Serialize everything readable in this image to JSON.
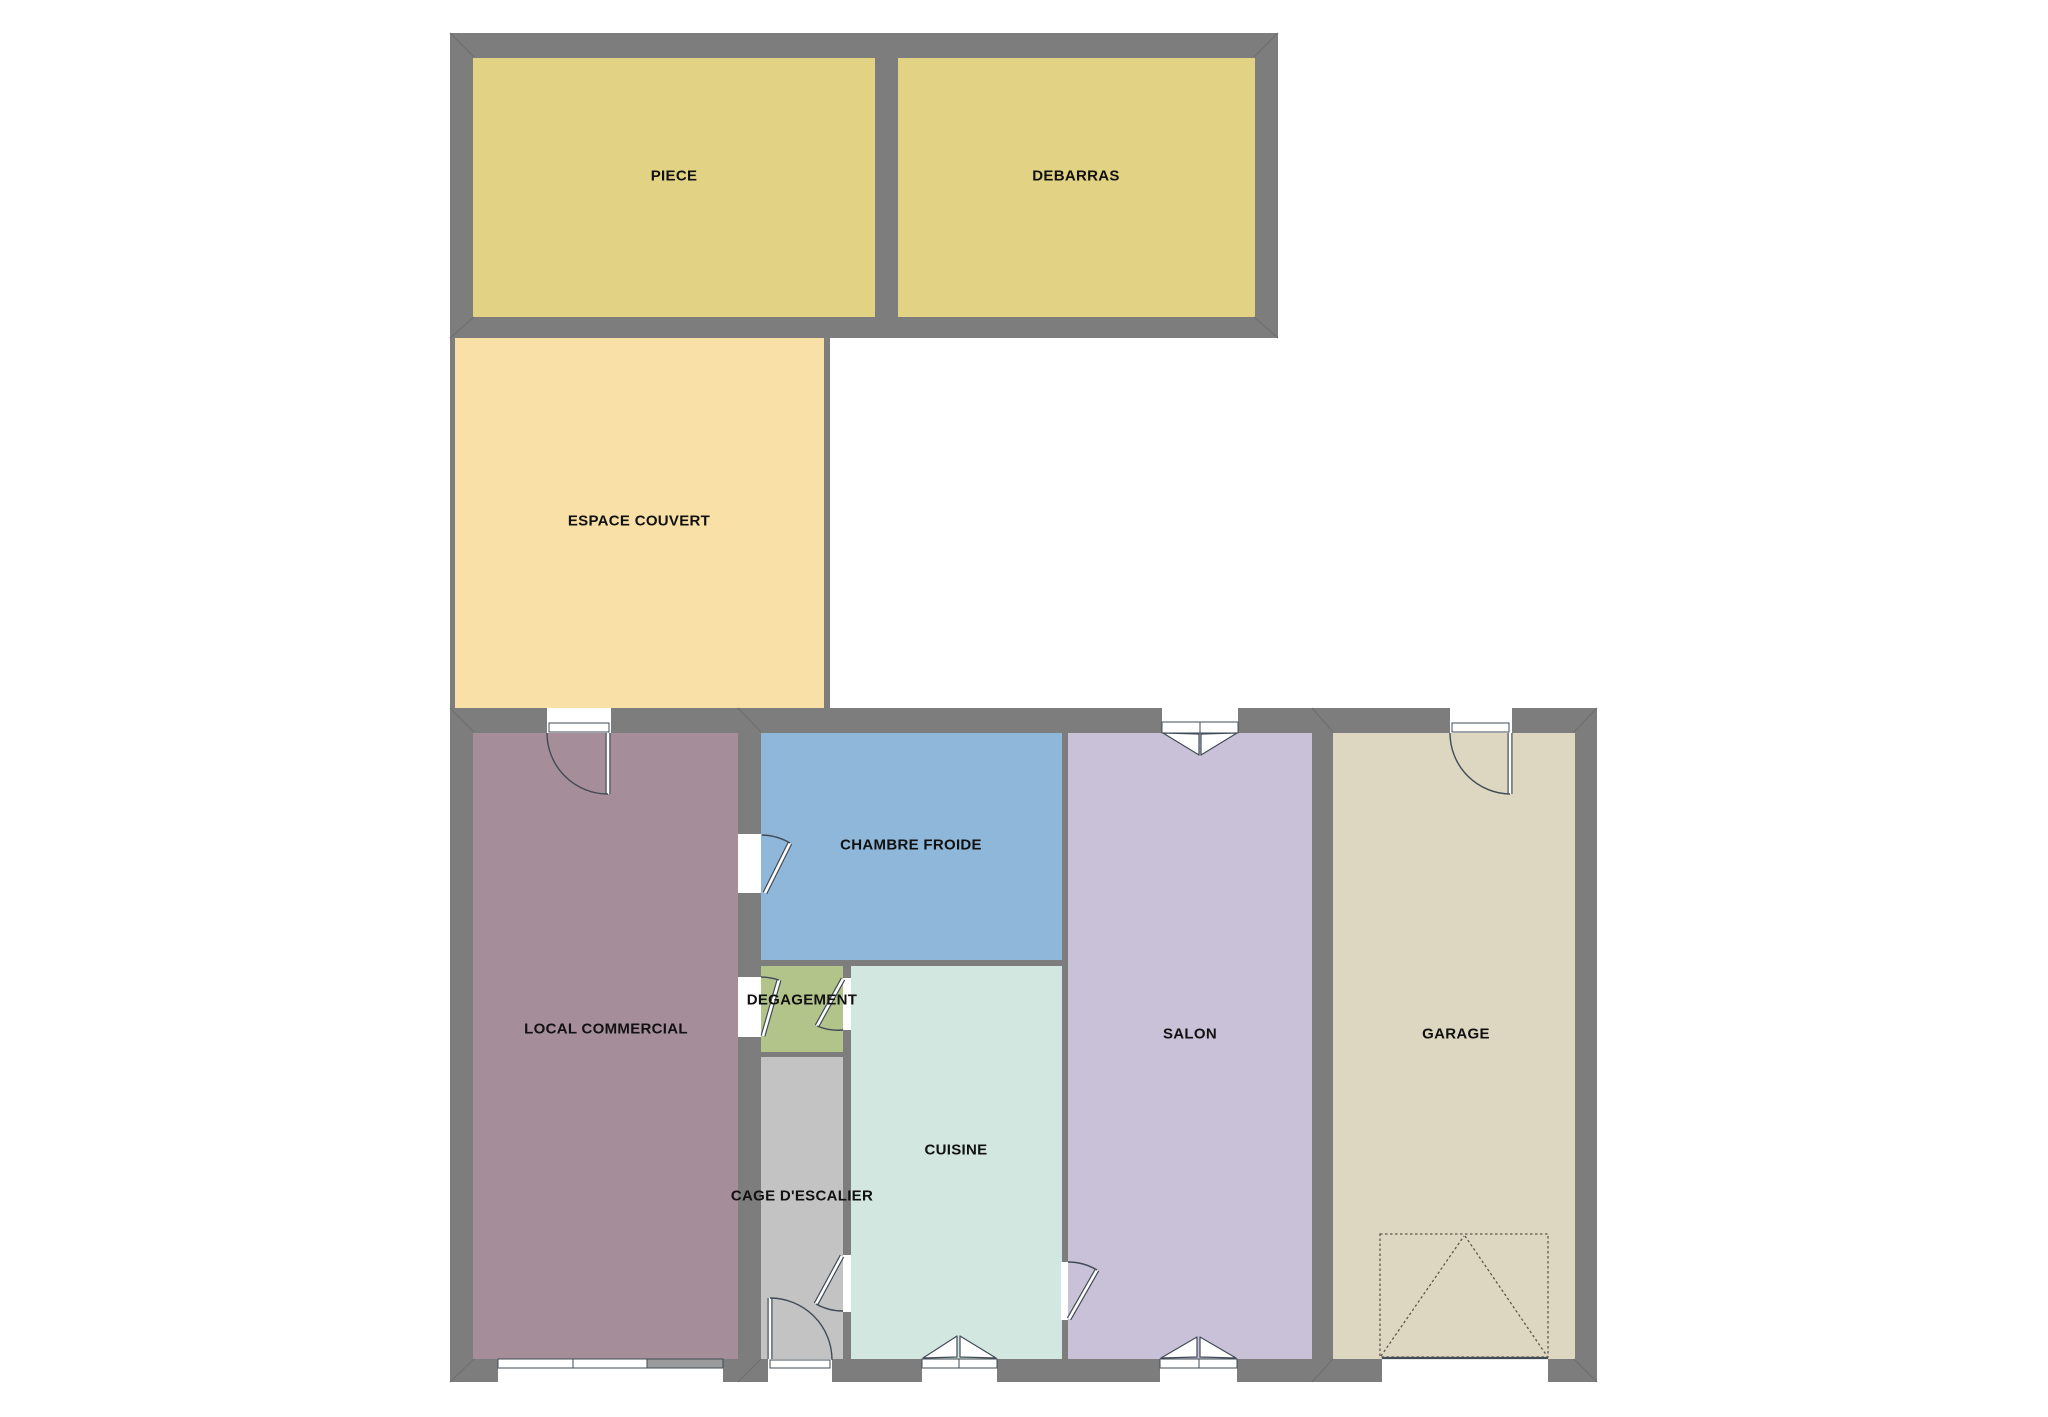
{
  "plan_title": "Floor plan",
  "colors": {
    "background": "#ffffff",
    "wall": "#7d7d7d",
    "wall_miter": "#6f6f6f",
    "line": "#414b56",
    "frame_fill": "#ffffff",
    "storefront_panel": "#9b9b9b",
    "garage_dash": "#5c584a",
    "label_text": "#111111"
  },
  "sections": [
    {
      "name": "upper-building",
      "x": 450,
      "y": 33,
      "w": 828,
      "h": 305
    },
    {
      "name": "espace-couvert-border",
      "x": 450,
      "y": 338,
      "w": 380,
      "h": 370
    },
    {
      "name": "lower-building",
      "x": 450,
      "y": 708,
      "w": 1147,
      "h": 674
    }
  ],
  "rooms": [
    {
      "id": "piece",
      "label": "PIECE",
      "color": "#e2d283",
      "x": 473,
      "y": 58,
      "w": 402,
      "h": 259,
      "label_cx": 674,
      "label_cy": 176
    },
    {
      "id": "debarras",
      "label": "DEBARRAS",
      "color": "#e2d283",
      "x": 898,
      "y": 58,
      "w": 357,
      "h": 259,
      "label_cx": 1076,
      "label_cy": 176
    },
    {
      "id": "espace-couvert",
      "label": "ESPACE COUVERT",
      "color": "#f8e0a6",
      "x": 455,
      "y": 338,
      "w": 369,
      "h": 370,
      "label_cx": 639,
      "label_cy": 521
    },
    {
      "id": "local-commercial",
      "label": "LOCAL COMMERCIAL",
      "color": "#a68d9a",
      "x": 473,
      "y": 733,
      "w": 265,
      "h": 626,
      "label_cx": 606,
      "label_cy": 1029
    },
    {
      "id": "chambre-froide",
      "label": "CHAMBRE FROIDE",
      "color": "#8fb7d9",
      "x": 761,
      "y": 733,
      "w": 301,
      "h": 227,
      "label_cx": 911,
      "label_cy": 845
    },
    {
      "id": "degagement",
      "label": "DEGAGEMENT",
      "color": "#b2c489",
      "x": 761,
      "y": 966,
      "w": 82,
      "h": 86,
      "label_cx": 802,
      "label_cy": 1000
    },
    {
      "id": "cuisine",
      "label": "CUISINE",
      "color": "#d2e7df",
      "x": 851,
      "y": 966,
      "w": 211,
      "h": 393,
      "label_cx": 956,
      "label_cy": 1150
    },
    {
      "id": "cage-escalier",
      "label": "CAGE D'ESCALIER",
      "color": "#c3c3c3",
      "x": 761,
      "y": 1057,
      "w": 82,
      "h": 302,
      "label_cx": 802,
      "label_cy": 1196
    },
    {
      "id": "salon",
      "label": "SALON",
      "color": "#c9c1d8",
      "x": 1068,
      "y": 733,
      "w": 244,
      "h": 626,
      "label_cx": 1190,
      "label_cy": 1034
    },
    {
      "id": "garage",
      "label": "GARAGE",
      "color": "#ddd7c1",
      "x": 1333,
      "y": 733,
      "w": 242,
      "h": 626,
      "label_cx": 1456,
      "label_cy": 1034
    }
  ],
  "openings": [
    {
      "name": "local-commercial-entry",
      "x": 547,
      "y": 708,
      "w": 64,
      "h": 25
    },
    {
      "name": "storefront-window",
      "x": 498,
      "y": 1359,
      "w": 225,
      "h": 23
    },
    {
      "name": "chambre-froide-door",
      "x": 738,
      "y": 834,
      "w": 23,
      "h": 59
    },
    {
      "name": "degagement-left-door",
      "x": 738,
      "y": 977,
      "w": 23,
      "h": 60
    },
    {
      "name": "degagement-right-door",
      "x": 843,
      "y": 978,
      "w": 8,
      "h": 52
    },
    {
      "name": "cage-interior-door",
      "x": 843,
      "y": 1255,
      "w": 8,
      "h": 57
    },
    {
      "name": "cage-exit-door",
      "x": 768,
      "y": 1359,
      "w": 64,
      "h": 23
    },
    {
      "name": "cuisine-exit-door",
      "x": 922,
      "y": 1359,
      "w": 75,
      "h": 23
    },
    {
      "name": "salon-window-top",
      "x": 1162,
      "y": 708,
      "w": 76,
      "h": 25
    },
    {
      "name": "salon-window-bottom",
      "x": 1160,
      "y": 1359,
      "w": 77,
      "h": 23
    },
    {
      "name": "cuisine-salon-door",
      "x": 1061,
      "y": 1262,
      "w": 7,
      "h": 58
    },
    {
      "name": "garage-entry-door",
      "x": 1450,
      "y": 708,
      "w": 62,
      "h": 25
    },
    {
      "name": "garage-door-opening",
      "x": 1382,
      "y": 1359,
      "w": 166,
      "h": 23
    }
  ],
  "frames": [
    {
      "name": "local-commercial-entry-frame",
      "x": 549,
      "y": 723,
      "w": 60,
      "h": 9,
      "dividers": []
    },
    {
      "name": "garage-entry-frame",
      "x": 1452,
      "y": 723,
      "w": 57,
      "h": 9,
      "dividers": []
    },
    {
      "name": "salon-window-top-frame",
      "x": 1162,
      "y": 722,
      "w": 76,
      "h": 11,
      "dividers": [
        1200
      ]
    },
    {
      "name": "storefront-frame",
      "x": 498,
      "y": 1359,
      "w": 225,
      "h": 9,
      "dividers": [
        573,
        647
      ],
      "panel": {
        "x": 647,
        "w": 76
      }
    },
    {
      "name": "cage-exit-frame",
      "x": 770,
      "y": 1360,
      "w": 60,
      "h": 8,
      "dividers": []
    },
    {
      "name": "cuisine-exit-frame",
      "x": 922,
      "y": 1359,
      "w": 75,
      "h": 9,
      "dividers": [
        959
      ]
    },
    {
      "name": "salon-window-bottom-frame",
      "x": 1160,
      "y": 1359,
      "w": 77,
      "h": 9,
      "dividers": [
        1199
      ]
    }
  ],
  "door_leaves": [
    {
      "name": "local-commercial-entry-leaf",
      "x1": 608,
      "y1": 733,
      "x2": 608,
      "y2": 794
    },
    {
      "name": "chambre-froide-leaf",
      "x1": 765,
      "y1": 893,
      "x2": 790,
      "y2": 843
    },
    {
      "name": "degagement-left-leaf",
      "x1": 763,
      "y1": 1036,
      "x2": 779,
      "y2": 980
    },
    {
      "name": "degagement-right-leaf",
      "x1": 843,
      "y1": 979,
      "x2": 817,
      "y2": 1026
    },
    {
      "name": "cage-interior-leaf",
      "x1": 842,
      "y1": 1256,
      "x2": 816,
      "y2": 1304
    },
    {
      "name": "cage-exit-leaf",
      "x1": 770,
      "y1": 1298,
      "x2": 770,
      "y2": 1359
    },
    {
      "name": "cuisine-salon-leaf",
      "x1": 1069,
      "y1": 1319,
      "x2": 1097,
      "y2": 1270
    },
    {
      "name": "garage-entry-leaf",
      "x1": 1510,
      "y1": 733,
      "x2": 1510,
      "y2": 794
    }
  ],
  "door_arcs": [
    {
      "name": "local-commercial-entry-arc",
      "d": "M547,733 A61,61 0 0 0 608,794"
    },
    {
      "name": "chambre-froide-arc",
      "d": "M762,835 A58,58 0 0 1 790,843"
    },
    {
      "name": "degagement-left-arc",
      "d": "M761,977 A59,59 0 0 1 779,980"
    },
    {
      "name": "degagement-right-arc",
      "d": "M843,1030 A54,54 0 0 1 817,1026"
    },
    {
      "name": "cage-interior-arc",
      "d": "M843,1311 A55,55 0 0 1 816,1304"
    },
    {
      "name": "cage-exit-arc",
      "d": "M770,1298 A62,62 0 0 1 832,1360"
    },
    {
      "name": "cuisine-salon-arc",
      "d": "M1068,1262 A57,57 0 0 1 1097,1270"
    },
    {
      "name": "garage-entry-arc",
      "d": "M1450,733 A61,61 0 0 0 1510,794"
    }
  ],
  "window_leaves": [
    {
      "name": "salon-window-top-left-leaf",
      "points": "1163,733 1199,755 1199,734"
    },
    {
      "name": "salon-window-top-right-leaf",
      "points": "1237,733 1201,755 1201,734"
    },
    {
      "name": "salon-window-bottom-left-leaf",
      "points": "1161,1358 1197,1337 1197,1357"
    },
    {
      "name": "salon-window-bottom-right-leaf",
      "points": "1236,1358 1200,1337 1200,1357"
    },
    {
      "name": "cuisine-exit-left-leaf",
      "points": "923,1358 957,1336 957,1357"
    },
    {
      "name": "cuisine-exit-right-leaf",
      "points": "996,1358 960,1336 960,1357"
    }
  ],
  "garage_door_symbol": {
    "rect": {
      "x": 1380,
      "y": 1234,
      "w": 168,
      "h": 123
    },
    "apex_x": 1464,
    "apex_y": 1236,
    "sill": {
      "x1": 1382,
      "y1": 1358,
      "x2": 1548,
      "y2": 1358
    }
  },
  "miters": [
    {
      "x1": 450,
      "y1": 33,
      "x2": 474,
      "y2": 57
    },
    {
      "x1": 1278,
      "y1": 33,
      "x2": 1254,
      "y2": 57
    },
    {
      "x1": 450,
      "y1": 338,
      "x2": 474,
      "y2": 317
    },
    {
      "x1": 1278,
      "y1": 338,
      "x2": 1254,
      "y2": 317
    },
    {
      "x1": 450,
      "y1": 708,
      "x2": 474,
      "y2": 732
    },
    {
      "x1": 1597,
      "y1": 708,
      "x2": 1574,
      "y2": 732
    },
    {
      "x1": 450,
      "y1": 1382,
      "x2": 474,
      "y2": 1359
    },
    {
      "x1": 1597,
      "y1": 1382,
      "x2": 1574,
      "y2": 1359
    },
    {
      "x1": 738,
      "y1": 708,
      "x2": 761,
      "y2": 732
    },
    {
      "x1": 1312,
      "y1": 708,
      "x2": 1333,
      "y2": 732
    },
    {
      "x1": 738,
      "y1": 1382,
      "x2": 761,
      "y2": 1359
    },
    {
      "x1": 1312,
      "y1": 1382,
      "x2": 1333,
      "y2": 1359
    }
  ]
}
